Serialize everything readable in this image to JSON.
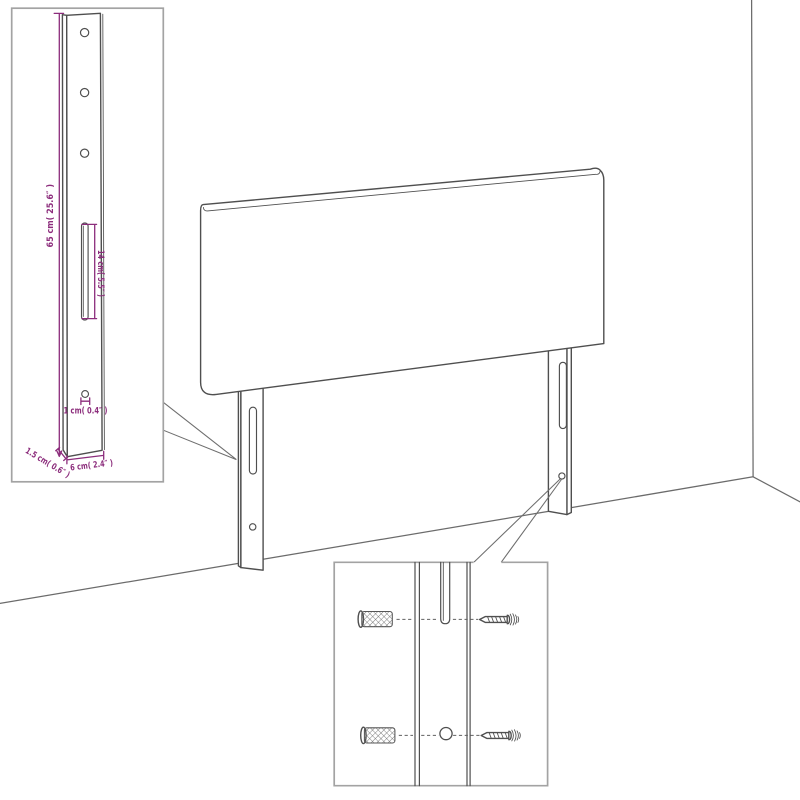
{
  "colors": {
    "dimension": "#8c2d7c",
    "line": "#4f4f4f",
    "border": "#a3a3a3",
    "callout": "#6e6e6e"
  },
  "diagram": {
    "subject": "headboard with two mounting legs standing against a wall corner",
    "insets": [
      "leg dimension detail",
      "wall mounting hardware detail"
    ]
  },
  "leg_inset": {
    "labels": {
      "height": "65 cm( 25.6″ )",
      "slot_length": "14 cm( 5.5″ )",
      "hole_diameter": "1 cm( 0.4″ )",
      "side_depth": "1.5 cm( 0.6″ )",
      "width": "6 cm( 2.4″ )"
    }
  },
  "hardware_inset": {
    "parts": {
      "plug": "wall-plug-icon",
      "screw": "screw-icon"
    }
  }
}
